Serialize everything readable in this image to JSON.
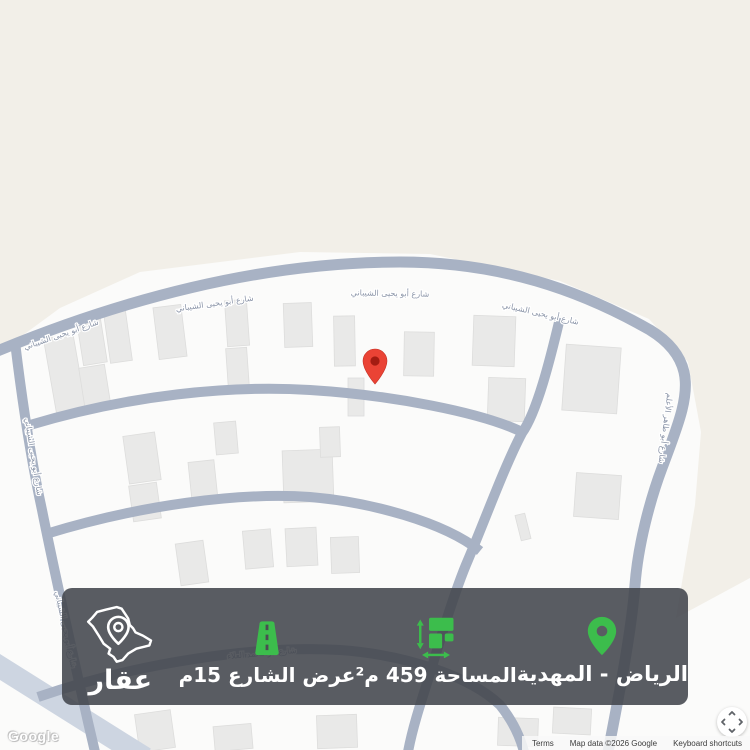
{
  "map": {
    "watermark": "Google",
    "attribution": {
      "terms": "Terms",
      "map_data": "Map data ©2026 Google",
      "keyboard_shortcuts": "Keyboard shortcuts"
    },
    "street_labels": {
      "main": "شارع أبو يحيى الشيباني",
      "right": "شارع أبو طاهر الأعلم",
      "lower": "شارع أبو محمد العلاء"
    },
    "colors": {
      "land_beige": "#f2efe8",
      "land_white": "#fbfbfa",
      "road": "#a8b2c4",
      "building": "#e9e9e8",
      "marker_red": "#EA4335"
    }
  },
  "info_bar": {
    "accent_green": "#3cbd4c",
    "bar_color": "rgba(66,69,76,0.88)",
    "location": {
      "label": "الرياض - المهدية"
    },
    "area": {
      "label": "المساحة 459 م²"
    },
    "street_width": {
      "label": "عرض الشارع 15م"
    },
    "brand": {
      "name": "عقار"
    }
  }
}
